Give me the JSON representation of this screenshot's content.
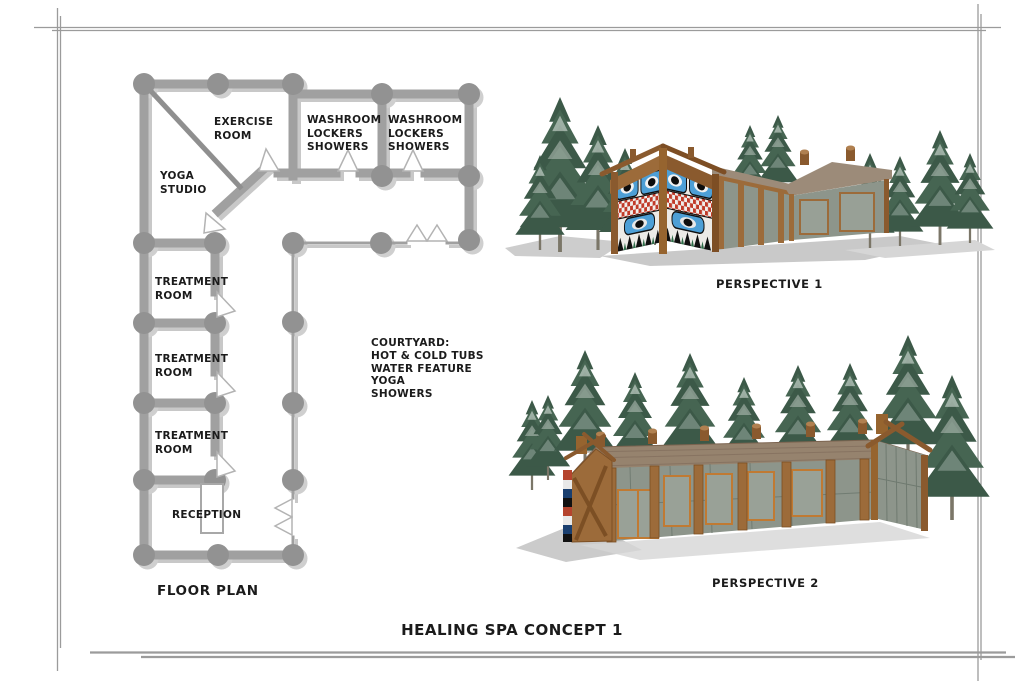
{
  "sheet": {
    "title": "HEALING SPA CONCEPT 1",
    "floor_plan": {
      "caption": "FLOOR PLAN",
      "rooms": {
        "exercise_room": "EXERCISE\nROOM",
        "washroom_1": "WASHROOM\nLOCKERS\nSHOWERS",
        "washroom_2": "WASHROOM\nLOCKERS\nSHOWERS",
        "yoga_studio": "YOGA\nSTUDIO",
        "treatment_room_1": "TREATMENT\nROOM",
        "treatment_room_2": "TREATMENT\nROOM",
        "treatment_room_3": "TREATMENT\nROOM",
        "reception": "RECEPTION"
      },
      "courtyard_note": "COURTYARD:\nHOT & COLD TUBS\nWATER FEATURE\nYOGA\nSHOWERS"
    },
    "perspectives": {
      "p1": "PERSPECTIVE 1",
      "p2": "PERSPECTIVE 2"
    },
    "colors": {
      "wall_gray": "#a0a0a0",
      "column_gray": "#929292",
      "wood_brown": "#9c6b3a",
      "dark_wood": "#7d4e24",
      "roof_taupe": "#96836e",
      "glass_gray_green": "#8d958b",
      "tree_green": "#3c5948",
      "mural_blue": "#4d9fd6",
      "mural_red": "#c03a28",
      "shadow_gray": "#cccccc",
      "border_gray": "#9b9b9b",
      "text_black": "#1b1b1b"
    }
  }
}
